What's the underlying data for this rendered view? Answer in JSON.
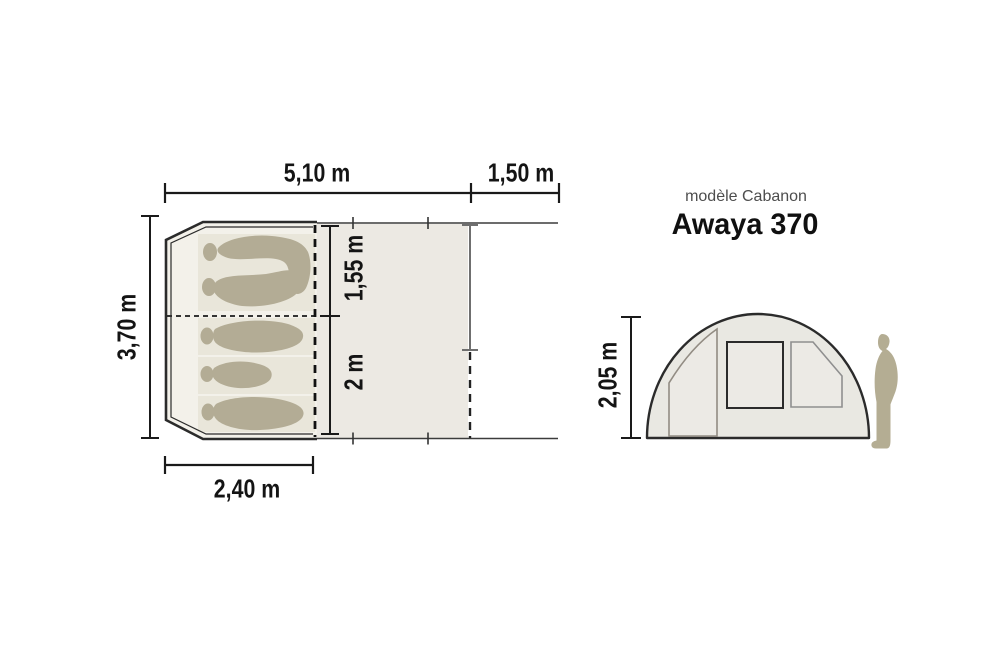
{
  "header": {
    "model_line": "modèle Cabanon",
    "model_name": "Awaya 370"
  },
  "floorplan": {
    "dim_total_length": "5,10 m",
    "dim_extension": "1,50 m",
    "dim_width": "3,70 m",
    "dim_inner_front": "1,55 m",
    "dim_inner_back": "2 m",
    "dim_bedroom_length": "2,40 m"
  },
  "sideview": {
    "dim_height": "2,05 m"
  },
  "icons": {
    "person": "standing-person-silhouette",
    "sleeping_bag": "sleeping-bag-top-view"
  },
  "colors": {
    "outline": "#2b2b2b",
    "dim_line": "#1a1a1a",
    "secondary_line": "#6f6f6f",
    "canopy_fill": "#ece9e3",
    "cabin_fill": "#f3f1ea",
    "mat_fill": "#e9e6da",
    "bag_fill": "#b3ac95",
    "dome_fill": "#e9e8e2",
    "panel_fill": "#eceae5",
    "panel_stroke": "#928c83",
    "person_fill": "#b4ad93",
    "label_gray": "#4d4d4d"
  }
}
